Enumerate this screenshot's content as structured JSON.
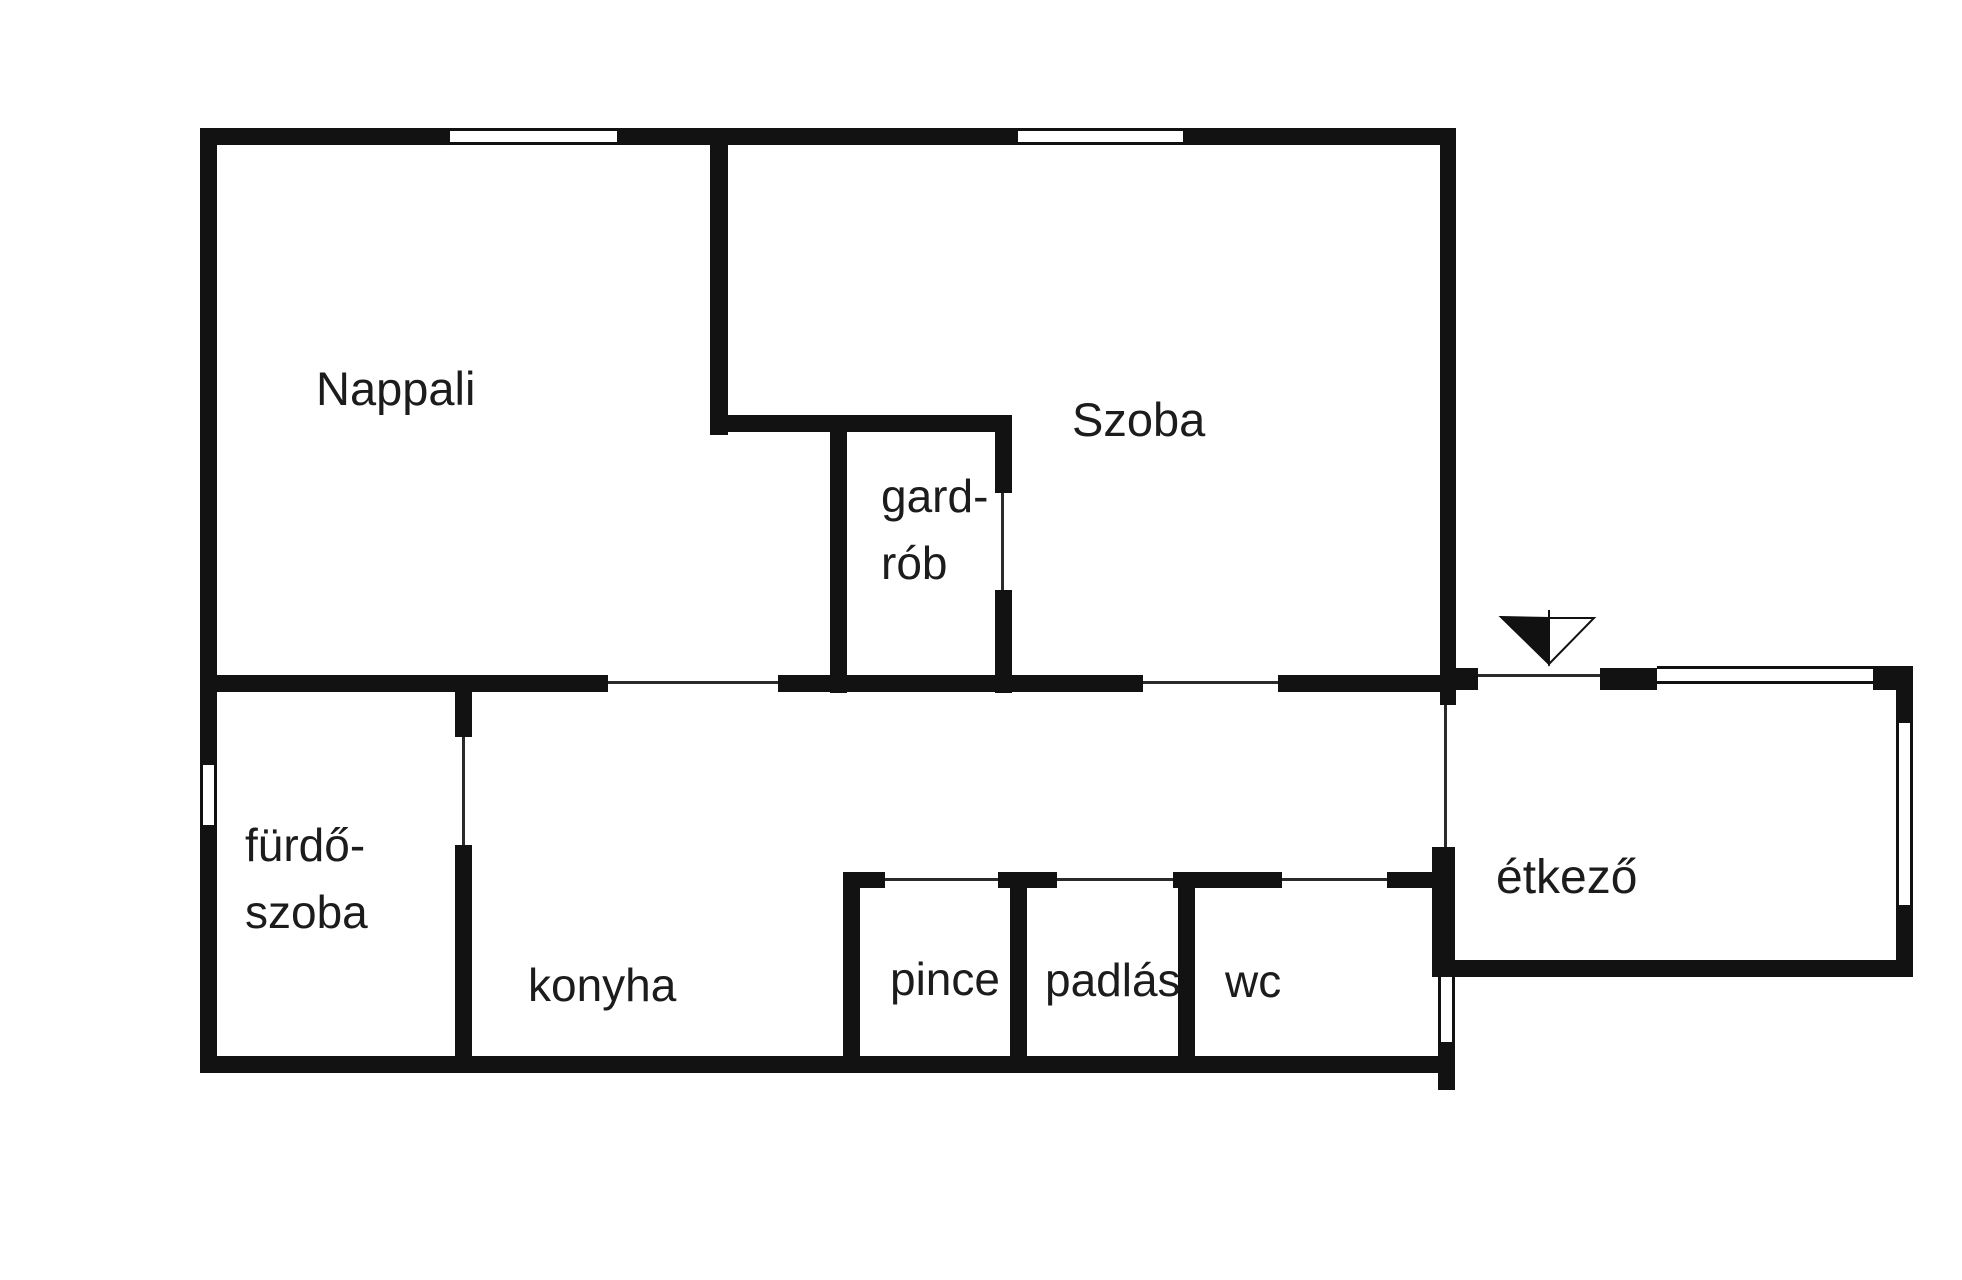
{
  "plan_title": "floor-plan",
  "colors": {
    "wall": "#121212",
    "text": "#1c1c1c",
    "background": "#ffffff"
  },
  "rooms": [
    {
      "name": "nappali",
      "label": "Nappali",
      "x": 316,
      "y": 355,
      "fs": 47
    },
    {
      "name": "szoba",
      "label": "Szoba",
      "x": 1072,
      "y": 386,
      "fs": 47
    },
    {
      "name": "gardrob",
      "label": "gard-\nrób",
      "x": 881,
      "y": 463,
      "fs": 46
    },
    {
      "name": "furdoszoba",
      "label": "fürdő-\nszoba",
      "x": 245,
      "y": 812,
      "fs": 46
    },
    {
      "name": "konyha",
      "label": "konyha",
      "x": 528,
      "y": 952,
      "fs": 46
    },
    {
      "name": "pince",
      "label": "pince",
      "x": 890,
      "y": 946,
      "fs": 46
    },
    {
      "name": "padlas",
      "label": "padlás",
      "x": 1045,
      "y": 947,
      "fs": 46
    },
    {
      "name": "wc",
      "label": "wc",
      "x": 1225,
      "y": 948,
      "fs": 46
    },
    {
      "name": "etkezo",
      "label": "étkező",
      "x": 1496,
      "y": 844,
      "fs": 48
    }
  ],
  "geometry": {
    "walls": [
      {
        "x": 200,
        "y": 128,
        "w": 250,
        "h": 17
      },
      {
        "x": 617,
        "y": 128,
        "w": 401,
        "h": 17
      },
      {
        "x": 1183,
        "y": 128,
        "w": 273,
        "h": 17
      },
      {
        "x": 200,
        "y": 128,
        "w": 17,
        "h": 637
      },
      {
        "x": 200,
        "y": 825,
        "w": 17,
        "h": 248
      },
      {
        "x": 200,
        "y": 1056,
        "w": 1255,
        "h": 17
      },
      {
        "x": 1440,
        "y": 128,
        "w": 16,
        "h": 577
      },
      {
        "x": 1432,
        "y": 847,
        "w": 23,
        "h": 130
      },
      {
        "x": 1438,
        "y": 1042,
        "w": 17,
        "h": 48
      },
      {
        "x": 200,
        "y": 675,
        "w": 408,
        "h": 17
      },
      {
        "x": 778,
        "y": 675,
        "w": 365,
        "h": 17
      },
      {
        "x": 1278,
        "y": 675,
        "w": 170,
        "h": 17
      },
      {
        "x": 710,
        "y": 145,
        "w": 18,
        "h": 290
      },
      {
        "x": 710,
        "y": 415,
        "w": 300,
        "h": 17
      },
      {
        "x": 830,
        "y": 415,
        "w": 17,
        "h": 278
      },
      {
        "x": 995,
        "y": 415,
        "w": 17,
        "h": 78
      },
      {
        "x": 995,
        "y": 590,
        "w": 17,
        "h": 103
      },
      {
        "x": 455,
        "y": 692,
        "w": 17,
        "h": 45
      },
      {
        "x": 455,
        "y": 845,
        "w": 17,
        "h": 228
      },
      {
        "x": 843,
        "y": 872,
        "w": 17,
        "h": 201
      },
      {
        "x": 843,
        "y": 872,
        "w": 42,
        "h": 16
      },
      {
        "x": 998,
        "y": 872,
        "w": 59,
        "h": 16
      },
      {
        "x": 1173,
        "y": 872,
        "w": 109,
        "h": 16
      },
      {
        "x": 1387,
        "y": 872,
        "w": 46,
        "h": 16
      },
      {
        "x": 1010,
        "y": 872,
        "w": 17,
        "h": 201
      },
      {
        "x": 1178,
        "y": 872,
        "w": 17,
        "h": 201
      },
      {
        "x": 1440,
        "y": 668,
        "w": 38,
        "h": 22
      },
      {
        "x": 1600,
        "y": 668,
        "w": 57,
        "h": 22
      },
      {
        "x": 1873,
        "y": 666,
        "w": 40,
        "h": 24
      },
      {
        "x": 1896,
        "y": 666,
        "w": 17,
        "h": 57
      },
      {
        "x": 1896,
        "y": 905,
        "w": 17,
        "h": 72
      },
      {
        "x": 1432,
        "y": 960,
        "w": 481,
        "h": 17
      }
    ],
    "doors": [
      {
        "x": 608,
        "y": 681,
        "w": 170,
        "h": 3
      },
      {
        "x": 1143,
        "y": 681,
        "w": 135,
        "h": 3
      },
      {
        "x": 1001,
        "y": 493,
        "w": 3,
        "h": 97
      },
      {
        "x": 462,
        "y": 737,
        "w": 3,
        "h": 108
      },
      {
        "x": 1444,
        "y": 705,
        "w": 3,
        "h": 142
      },
      {
        "x": 1478,
        "y": 674,
        "w": 122,
        "h": 3
      },
      {
        "x": 885,
        "y": 878,
        "w": 113,
        "h": 3
      },
      {
        "x": 1057,
        "y": 878,
        "w": 116,
        "h": 3
      },
      {
        "x": 1282,
        "y": 878,
        "w": 105,
        "h": 3
      }
    ],
    "windows": [
      {
        "x": 450,
        "y": 128,
        "w": 167,
        "h": 17,
        "dir": "h"
      },
      {
        "x": 1018,
        "y": 128,
        "w": 165,
        "h": 17,
        "dir": "h"
      },
      {
        "x": 200,
        "y": 765,
        "w": 17,
        "h": 60,
        "dir": "v"
      },
      {
        "x": 1657,
        "y": 666,
        "w": 216,
        "h": 18,
        "dir": "h"
      },
      {
        "x": 1896,
        "y": 723,
        "w": 17,
        "h": 182,
        "dir": "v"
      },
      {
        "x": 1438,
        "y": 977,
        "w": 17,
        "h": 65,
        "dir": "v"
      }
    ],
    "arrow": {
      "x": 1495,
      "y": 608,
      "w": 105,
      "h": 62
    }
  }
}
